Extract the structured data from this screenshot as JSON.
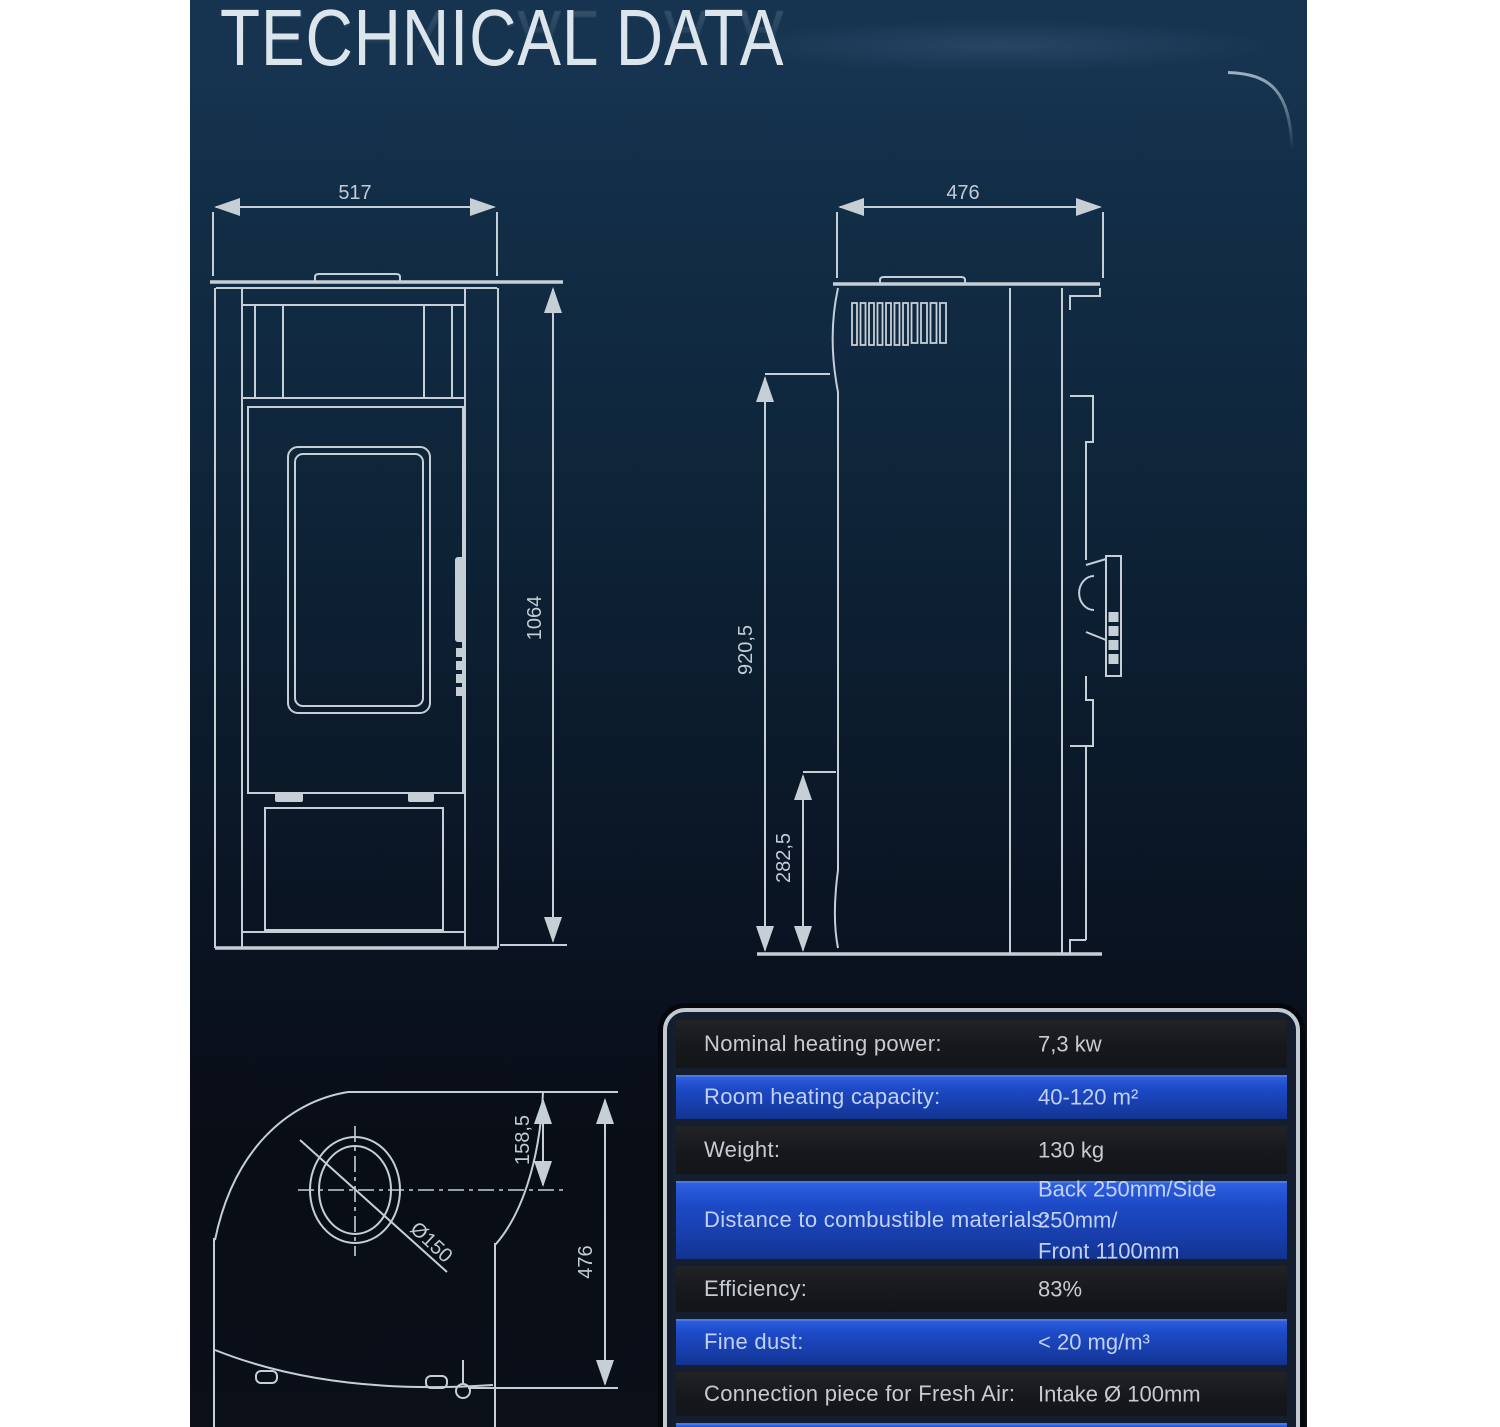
{
  "title": "TECHNICAL DATA",
  "colors": {
    "background_top": "#163450",
    "background_bottom": "#0a0f18",
    "line": "#c6ced6",
    "table_border": "#c3cad2",
    "row_dark": "#17181c",
    "row_blue": "#1d4ac7",
    "text": "#c6cbd3"
  },
  "front_view": {
    "width_dim": "517",
    "height_dim": "1064"
  },
  "side_view": {
    "depth_dim": "476",
    "upper_height_dim": "920,5",
    "lower_height_dim": "282,5"
  },
  "top_view": {
    "flue_offset_dim": "158,5",
    "depth_dim": "476",
    "flue_diameter_dim": "Ø150"
  },
  "spec_table": {
    "rows": [
      {
        "label": "Nominal heating power:",
        "values": [
          "7,3 kw"
        ]
      },
      {
        "label": "Room heating capacity:",
        "values": [
          "40-120 m²"
        ]
      },
      {
        "label": "Weight:",
        "values": [
          "130 kg"
        ]
      },
      {
        "label": "Distance to combustible materials:",
        "values": [
          "Back 250mm/Side 250mm/",
          "Front 1100mm"
        ]
      },
      {
        "label": "Efficiency:",
        "values": [
          "83%"
        ]
      },
      {
        "label": "Fine dust:",
        "values": [
          "< 20 mg/m³"
        ]
      },
      {
        "label": "Connection piece for Fresh Air:",
        "values": [
          "Intake Ø 100mm"
        ]
      },
      {
        "label": "",
        "values": [
          ""
        ]
      }
    ]
  }
}
